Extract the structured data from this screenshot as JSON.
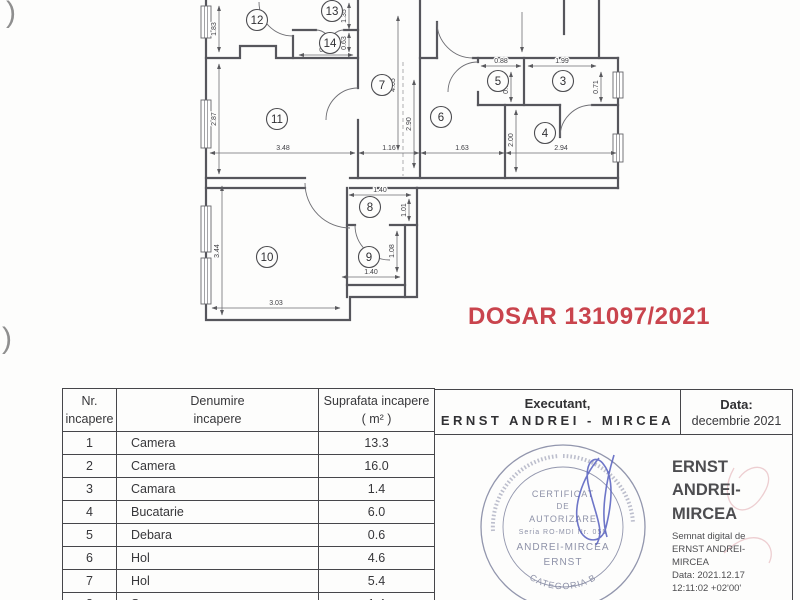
{
  "dosar": {
    "text": "DOSAR 131097/2021",
    "color": "#c9444d"
  },
  "artifacts": {
    "top": ")",
    "bottom": ")"
  },
  "floor_plan": {
    "rooms": [
      {
        "n": "12",
        "cx": 257,
        "cy": 20
      },
      {
        "n": "13",
        "cx": 332,
        "cy": 11
      },
      {
        "n": "14",
        "cx": 330,
        "cy": 43
      },
      {
        "n": "7",
        "cx": 382,
        "cy": 85
      },
      {
        "n": "5",
        "cx": 498,
        "cy": 81
      },
      {
        "n": "3",
        "cx": 563,
        "cy": 81
      },
      {
        "n": "11",
        "cx": 277,
        "cy": 119
      },
      {
        "n": "6",
        "cx": 441,
        "cy": 117
      },
      {
        "n": "4",
        "cx": 545,
        "cy": 133
      },
      {
        "n": "8",
        "cx": 370,
        "cy": 207
      },
      {
        "n": "9",
        "cx": 369,
        "cy": 257
      },
      {
        "n": "10",
        "cx": 267,
        "cy": 257
      }
    ],
    "dims": [
      {
        "t": "1.83",
        "x1": 219,
        "y1": 6,
        "x2": 219,
        "y2": 52,
        "tx": 219,
        "ty": 29,
        "rot": true
      },
      {
        "t": "2.87",
        "x1": 219,
        "y1": 64,
        "x2": 219,
        "y2": 174,
        "tx": 219,
        "ty": 119,
        "rot": true
      },
      {
        "t": "3.48",
        "x1": 210,
        "y1": 153,
        "x2": 355,
        "y2": 153,
        "tx": 283,
        "ty": 150,
        "rot": false
      },
      {
        "t": "1.16",
        "x1": 359,
        "y1": 153,
        "x2": 419,
        "y2": 153,
        "tx": 389,
        "ty": 150,
        "rot": false
      },
      {
        "t": "1.63",
        "x1": 421,
        "y1": 153,
        "x2": 504,
        "y2": 153,
        "tx": 462,
        "ty": 150,
        "rot": false
      },
      {
        "t": "2.94",
        "x1": 506,
        "y1": 153,
        "x2": 616,
        "y2": 153,
        "tx": 561,
        "ty": 150,
        "rot": false
      },
      {
        "t": "4.65",
        "x1": 398,
        "y1": 16,
        "x2": 398,
        "y2": 150,
        "tx": 398,
        "ty": 85,
        "rot": true
      },
      {
        "t": "2.90",
        "x1": 414,
        "y1": 80,
        "x2": 414,
        "y2": 168,
        "tx": 414,
        "ty": 124,
        "rot": true
      },
      {
        "t": "2.00",
        "x1": 516,
        "y1": 110,
        "x2": 516,
        "y2": 172,
        "tx": 516,
        "ty": 140,
        "rot": true
      },
      {
        "t": "0.88",
        "x1": 481,
        "y1": 66,
        "x2": 521,
        "y2": 66,
        "tx": 501,
        "ty": 63,
        "rot": false
      },
      {
        "t": "1.99",
        "x1": 528,
        "y1": 66,
        "x2": 596,
        "y2": 66,
        "tx": 562,
        "ty": 63,
        "rot": false
      },
      {
        "t": "0.71",
        "x1": 511,
        "y1": 72,
        "x2": 511,
        "y2": 102,
        "tx": 511,
        "ty": 87,
        "rot": true
      },
      {
        "t": "0.71",
        "x1": 601,
        "y1": 72,
        "x2": 601,
        "y2": 102,
        "tx": 601,
        "ty": 87,
        "rot": true
      },
      {
        "t": "0.90",
        "x1": 299,
        "y1": 55,
        "x2": 353,
        "y2": 55,
        "tx": 326,
        "ty": 52,
        "rot": false
      },
      {
        "t": "0.63",
        "x1": 349,
        "y1": 33,
        "x2": 349,
        "y2": 52,
        "tx": 349,
        "ty": 43,
        "rot": true
      },
      {
        "t": "1.35",
        "x1": 349,
        "y1": 3,
        "x2": 349,
        "y2": 29,
        "tx": 349,
        "ty": 16,
        "rot": true
      },
      {
        "t": "1.40",
        "x1": 349,
        "y1": 195,
        "x2": 411,
        "y2": 195,
        "tx": 380,
        "ty": 192,
        "rot": false
      },
      {
        "t": "1.01",
        "x1": 409,
        "y1": 199,
        "x2": 409,
        "y2": 221,
        "tx": 409,
        "ty": 210,
        "rot": true
      },
      {
        "t": "1.40",
        "x1": 342,
        "y1": 277,
        "x2": 400,
        "y2": 277,
        "tx": 371,
        "ty": 274,
        "rot": false
      },
      {
        "t": "1.08",
        "x1": 397,
        "y1": 231,
        "x2": 397,
        "y2": 272,
        "tx": 397,
        "ty": 251,
        "rot": true
      },
      {
        "t": "3.44",
        "x1": 222,
        "y1": 186,
        "x2": 222,
        "y2": 315,
        "tx": 222,
        "ty": 251,
        "rot": true
      },
      {
        "t": "3.03",
        "x1": 212,
        "y1": 308,
        "x2": 340,
        "y2": 308,
        "tx": 276,
        "ty": 305,
        "rot": false
      }
    ]
  },
  "rooms_table": {
    "col_headers": [
      {
        "line1": "Nr.",
        "line2": "incapere"
      },
      {
        "line1": "Denumire",
        "line2": "incapere"
      },
      {
        "line1": "Suprafata incapere",
        "line2": "( m² )"
      }
    ],
    "rows": [
      {
        "nr": "1",
        "name": "Camera",
        "area": "13.3"
      },
      {
        "nr": "2",
        "name": "Camera",
        "area": "16.0"
      },
      {
        "nr": "3",
        "name": "Camara",
        "area": "1.4"
      },
      {
        "nr": "4",
        "name": "Bucatarie",
        "area": "6.0"
      },
      {
        "nr": "5",
        "name": "Debara",
        "area": "0.6"
      },
      {
        "nr": "6",
        "name": "Hol",
        "area": "4.6"
      },
      {
        "nr": "7",
        "name": "Hol",
        "area": "5.4"
      },
      {
        "nr": "8",
        "name": "Sas",
        "area": "1.4"
      }
    ]
  },
  "exec_table": {
    "executant_label": "Executant,",
    "executant_name": "ERNST ANDREI - MIRCEA",
    "data_label": "Data:",
    "data_value": "decembrie 2021"
  },
  "stamp": {
    "line1": "CERTIFICAT",
    "line2": "DE",
    "line3": "AUTORIZARE",
    "line4": "Seria RO-MDI Nr. 055",
    "line5": "ANDREI-MIRCEA",
    "line6": "ERNST",
    "bottom_arc": "CATEGORIA B"
  },
  "signature": {
    "name_line1": "ERNST",
    "name_line2": "ANDREI-",
    "name_line3": "MIRCEA",
    "detail1": "Semnat digital de",
    "detail2": "ERNST ANDREI-",
    "detail3": "MIRCEA",
    "detail4": "Data: 2021.12.17",
    "detail5": "12:11:02 +02'00'"
  }
}
